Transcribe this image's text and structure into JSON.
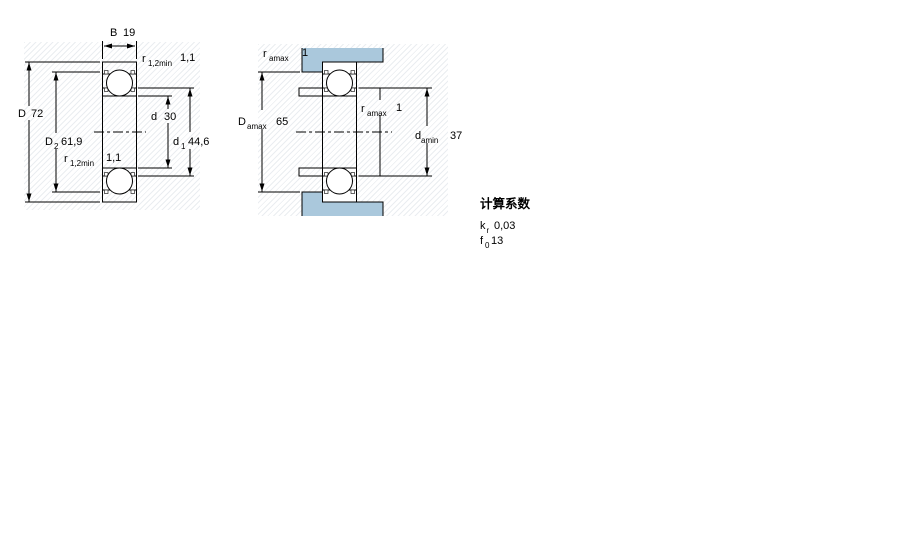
{
  "figures": {
    "left": {
      "name": "bearing-cross-section",
      "labels": {
        "B": {
          "sym": "B",
          "val": "19"
        },
        "D": {
          "sym": "D",
          "val": "72"
        },
        "D2": {
          "sym": "D",
          "sub": "2",
          "val": "61,9"
        },
        "d": {
          "sym": "d",
          "val": "30"
        },
        "d1": {
          "sym": "d",
          "sub": "1",
          "val": "44,6"
        },
        "r_top": {
          "sym": "r",
          "sub": "1,2min",
          "val": "1,1"
        },
        "r_bottom": {
          "sym": "r",
          "sub": "1,2min",
          "val": "1,1"
        }
      }
    },
    "right": {
      "name": "bearing-abutment-dimensions",
      "labels": {
        "r_a_top": {
          "sym": "r",
          "sub": "amax",
          "val": "1"
        },
        "D_a": {
          "sym": "D",
          "sub": "amax",
          "val": "65"
        },
        "r_a_mid": {
          "sym": "r",
          "sub": "amax",
          "val": "1"
        },
        "d_a": {
          "sym": "d",
          "sub": "amin",
          "val": "37"
        }
      }
    }
  },
  "calc_factors": {
    "title": "计算系数",
    "rows": [
      {
        "sym": "k",
        "sub": "r",
        "val": "0,03"
      },
      {
        "sym": "f",
        "sub": "0",
        "val": "13"
      }
    ]
  },
  "colors": {
    "part_fill": "#aac8dc",
    "line": "#000000",
    "background": "#ffffff"
  }
}
